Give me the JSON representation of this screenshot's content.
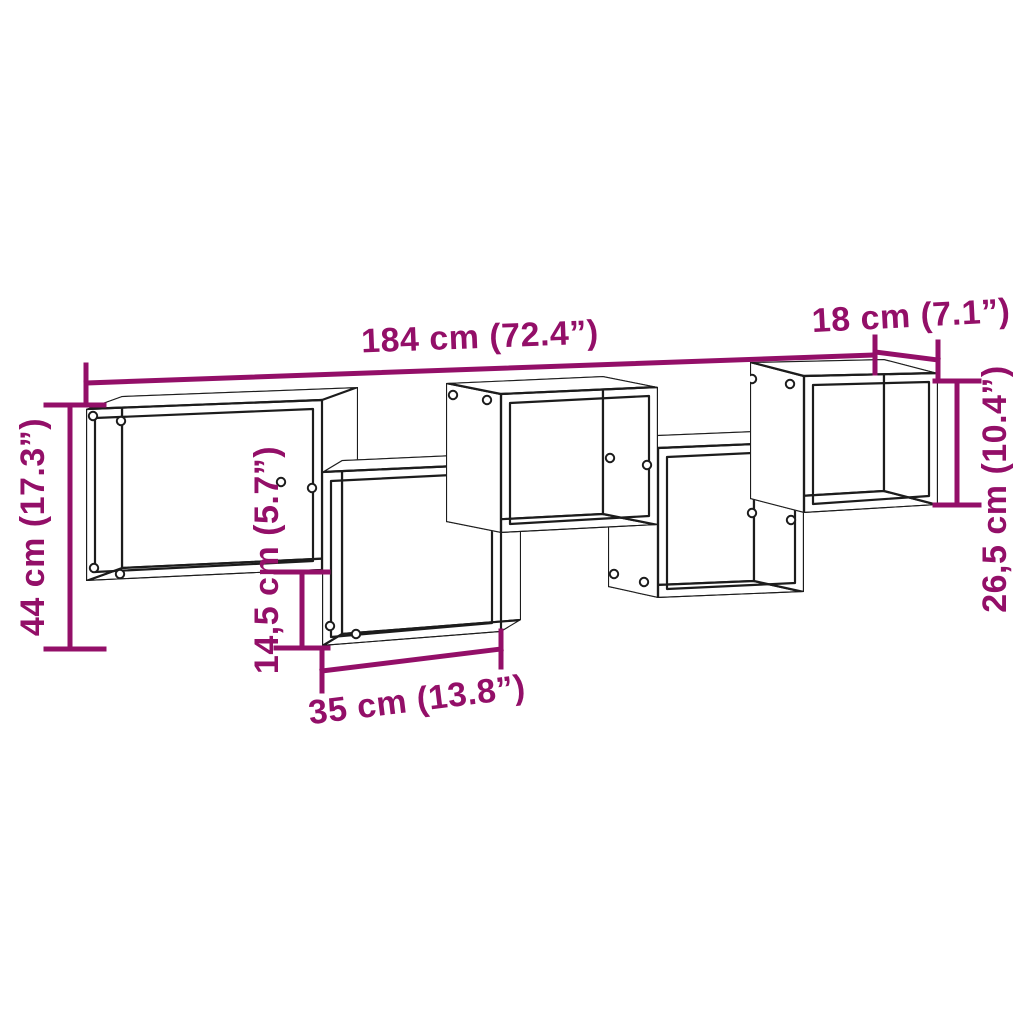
{
  "figure": {
    "description": "Staggered wall shelf with five open cube compartments, technical dimension drawing"
  },
  "dimensions": {
    "overall_width": {
      "label": "184 cm (72.4”)",
      "cm": "184",
      "inches": "72.4"
    },
    "depth": {
      "label": "18 cm (7.1”)",
      "cm": "18",
      "inches": "7.1"
    },
    "overall_height": {
      "label": "44 cm (17.3”)",
      "cm": "44",
      "inches": "17.3"
    },
    "compartment_height": {
      "label": "26,5 cm (10.4”)",
      "cm": "26,5",
      "inches": "10.4"
    },
    "stagger_offset": {
      "label": "14,5 cm (5.7”)",
      "cm": "14,5",
      "inches": "5.7"
    },
    "compartment_width": {
      "label": "35 cm (13.8”)",
      "cm": "35",
      "inches": "13.8"
    }
  },
  "colors": {
    "dimension_annotation": "#930F68",
    "drawing_outline": "#1c1c1c",
    "background": "#ffffff"
  }
}
